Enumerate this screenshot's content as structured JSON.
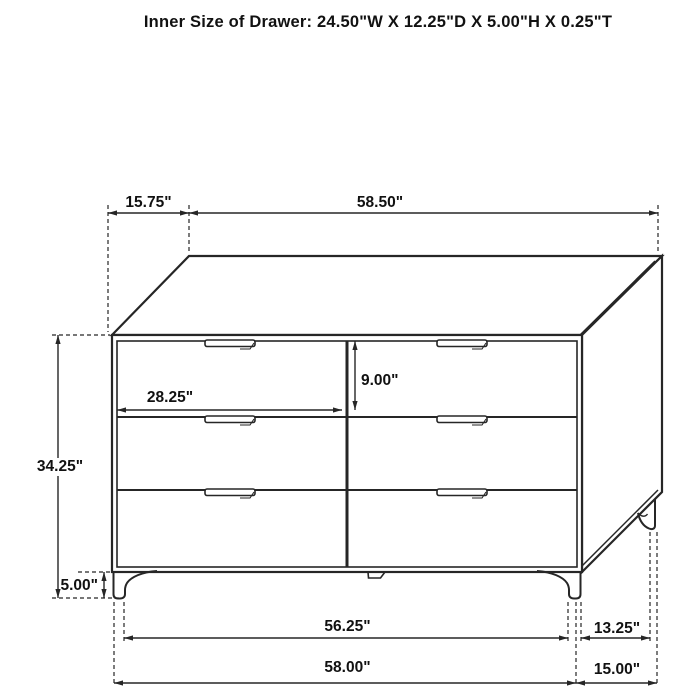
{
  "title": "Inner Size of Drawer: 24.50\"W X 12.25\"D X 5.00\"H X 0.25\"T",
  "diagram_subject": "6-drawer dresser line drawing with dimension callouts",
  "dimensions": {
    "top_depth": "15.75\"",
    "top_width": "58.50\"",
    "overall_height": "34.25\"",
    "drawer_front_width": "28.25\"",
    "drawer_front_height": "9.00\"",
    "leg_height": "5.00\"",
    "leg_span_width": "56.25\"",
    "base_width": "58.00\"",
    "leg_span_depth": "13.25\"",
    "base_depth": "15.00\""
  },
  "colors": {
    "line": "#262626",
    "background": "#ffffff",
    "text": "#111111"
  }
}
